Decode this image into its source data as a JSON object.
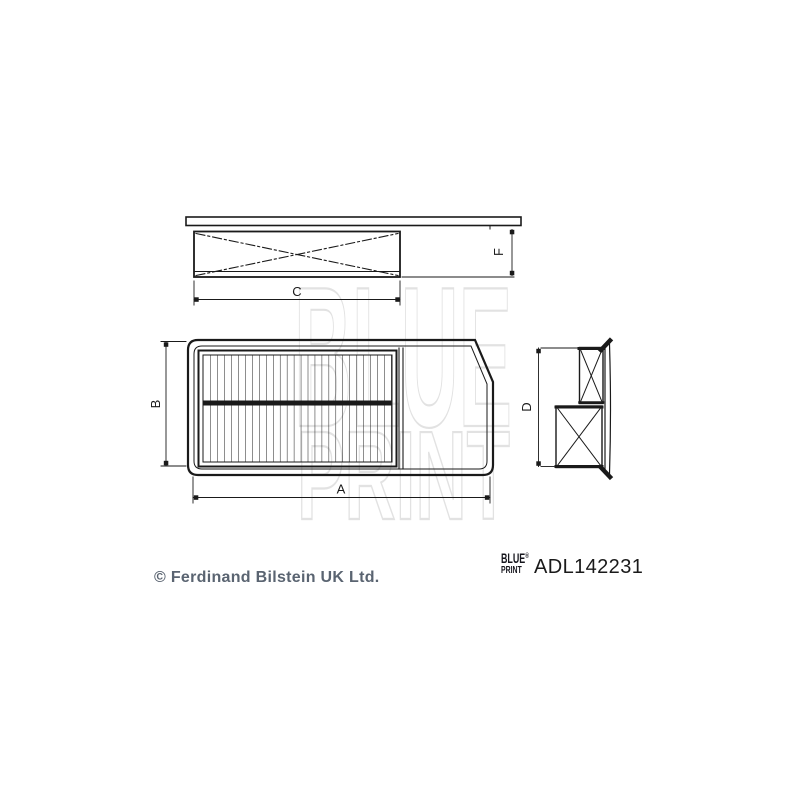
{
  "page": {
    "background": "#ffffff"
  },
  "watermark": {
    "line1": "BLUE",
    "line2": "PRINT",
    "color": "#e2e2e2"
  },
  "drawing": {
    "line_color": "#1a1a1a",
    "dimension_labels": {
      "a": "A",
      "b": "B",
      "c": "C",
      "d": "D",
      "f": "F"
    }
  },
  "footer": {
    "copyright": "© Ferdinand Bilstein UK Ltd.",
    "brand": {
      "line1": "BLUE",
      "line2": "PRINT",
      "registered_mark": "®"
    },
    "part_number": "ADL142231"
  }
}
